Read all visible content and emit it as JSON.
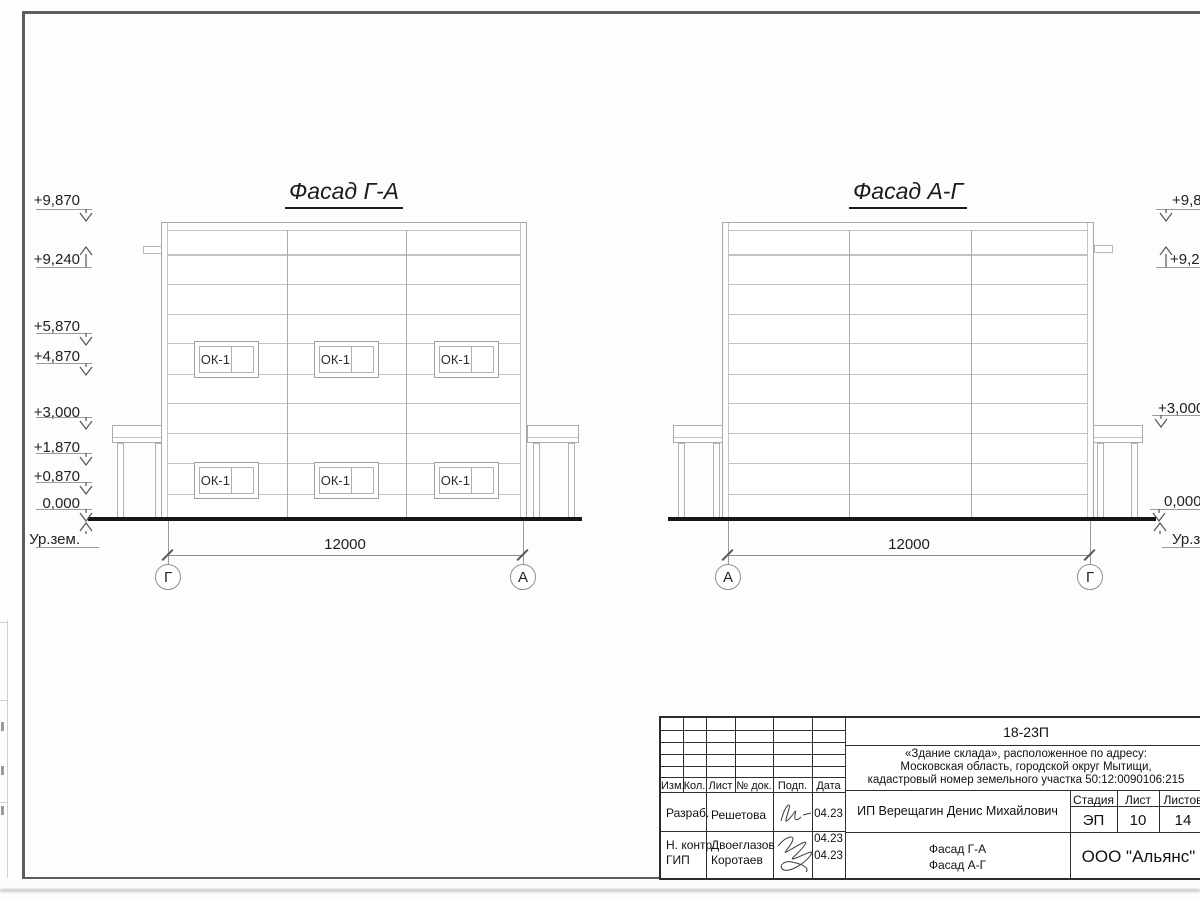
{
  "facades": [
    {
      "title": "Фасад Г-А",
      "dimension": "12000",
      "axis_left": "Г",
      "axis_right": "А",
      "window_label": "ОК-1"
    },
    {
      "title": "Фасад А-Г",
      "dimension": "12000",
      "axis_left": "А",
      "axis_right": "Г"
    }
  ],
  "elevations_left": [
    "+9,870",
    "+9,240",
    "+5,870",
    "+4,870",
    "+3,000",
    "+1,870",
    "+0,870",
    "0,000",
    "Ур.зем."
  ],
  "elevations_right": [
    "+9,870",
    "+9,240",
    "+3,000",
    "0,000",
    "Ур.зем."
  ],
  "title_block": {
    "code": "18-23П",
    "object_line1": "«Здание склада», расположенное по адресу:",
    "object_line2": "Московская область, городской округ Мытищи,",
    "object_line3": "кадастровый номер земельного участка 50:12:0090106:215",
    "client": "ИП Верещагин Денис Михайлович",
    "sheet_name_line1": "Фасад Г-А",
    "sheet_name_line2": "Фасад А-Г",
    "organization": "ООО \"Альянс\"",
    "columns": {
      "izm": "Изм.",
      "kol": "Кол.",
      "list": "Лист",
      "doc": "№ док.",
      "podp": "Подп.",
      "data": "Дата"
    },
    "stage_label": "Стадия",
    "sheet_label": "Лист",
    "sheets_label": "Листов",
    "stage_value": "ЭП",
    "sheet_value": "10",
    "sheets_value": "14",
    "roles": [
      {
        "role": "Разраб.",
        "name": "Решетова",
        "date": "04.23"
      },
      {
        "role": "Н. контр.",
        "name": "Двоеглазов",
        "date": "04.23"
      },
      {
        "role": "ГИП",
        "name": "Коротаев",
        "date": "04.23"
      }
    ]
  },
  "icons": {
    "elevation_arrow_down": "∨",
    "elevation_arrow_up": "∧"
  }
}
